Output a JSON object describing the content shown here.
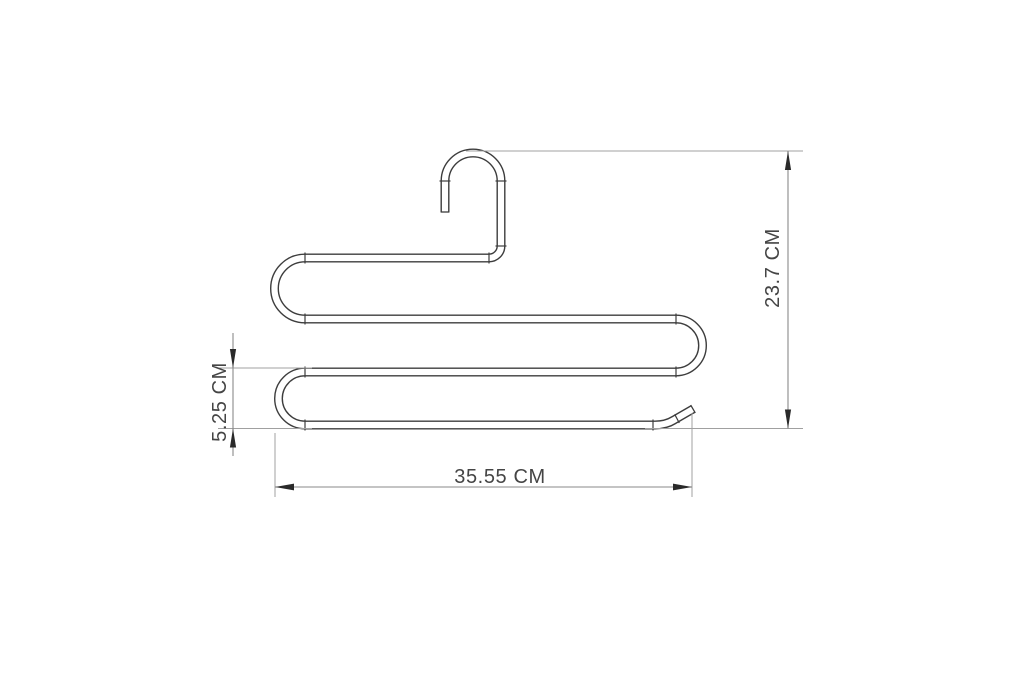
{
  "drawing": {
    "figure": "s-shaped-multi-tier-pants-hanger-outline",
    "dimensions": {
      "total_height": {
        "label": "23.7 CM",
        "value": 23.7,
        "unit": "CM",
        "orientation": "vertical"
      },
      "tier_spacing": {
        "label": "5.25 CM",
        "value": 5.25,
        "unit": "CM",
        "orientation": "vertical"
      },
      "total_width": {
        "label": "35.55 CM",
        "value": 35.55,
        "unit": "CM",
        "orientation": "horizontal"
      }
    },
    "colors": {
      "outline": "#3d3d3d",
      "extension": "#a0a0a0",
      "dimension": "#8a8a8a",
      "arrow": "#2a2a2a",
      "text": "#454545",
      "background": "#ffffff"
    }
  }
}
